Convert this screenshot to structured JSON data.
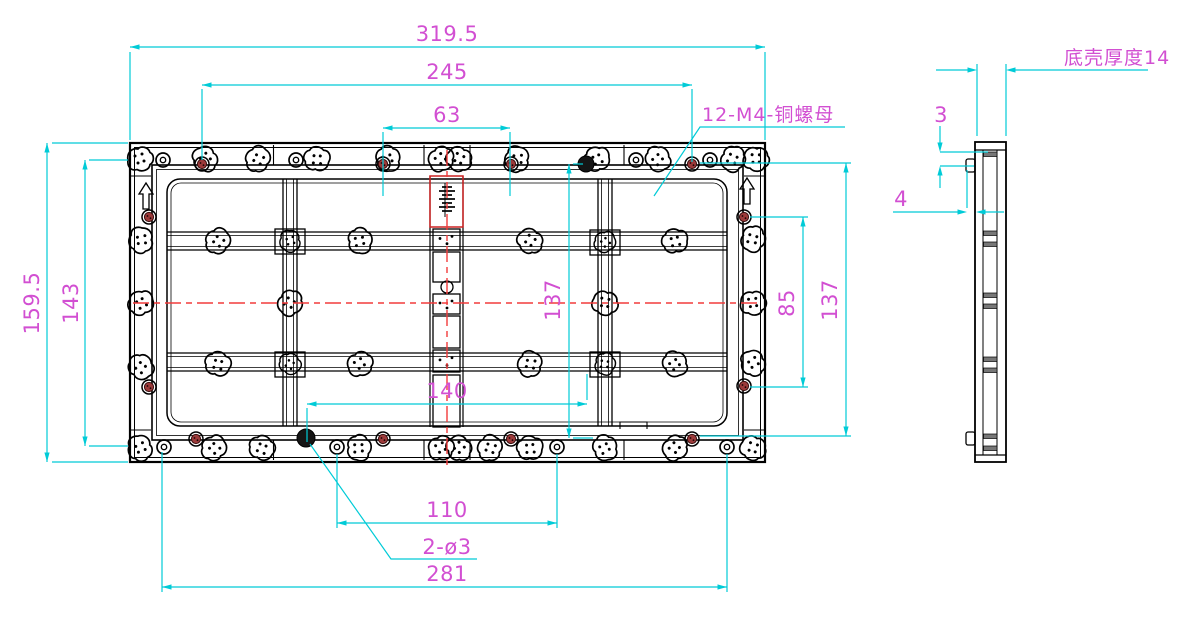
{
  "drawing": {
    "dims": {
      "total_width": "319.5",
      "screw_span_width": "245",
      "top_hole_span": "63",
      "total_height": "159.5",
      "inner_height": "143",
      "mid_height": "137",
      "lower_width": "140",
      "right_screw_span": "85",
      "right_height": "137",
      "bottom_hole_span": "110",
      "bottom_width": "281",
      "side_offset_3": "3",
      "side_offset_4": "4"
    },
    "annotations": {
      "nut_callout": "12-M4-铜螺母",
      "hole_callout": "2-ø3",
      "shell_thickness": "底壳厚度14"
    },
    "colors": {
      "dimension_lines": "#00CBD7",
      "dimension_text": "#D24FD2",
      "centerline": "#F23B3B",
      "geometry": "#000000",
      "screw_fill": "#9C3A3A",
      "background": "#FFFFFF"
    }
  }
}
